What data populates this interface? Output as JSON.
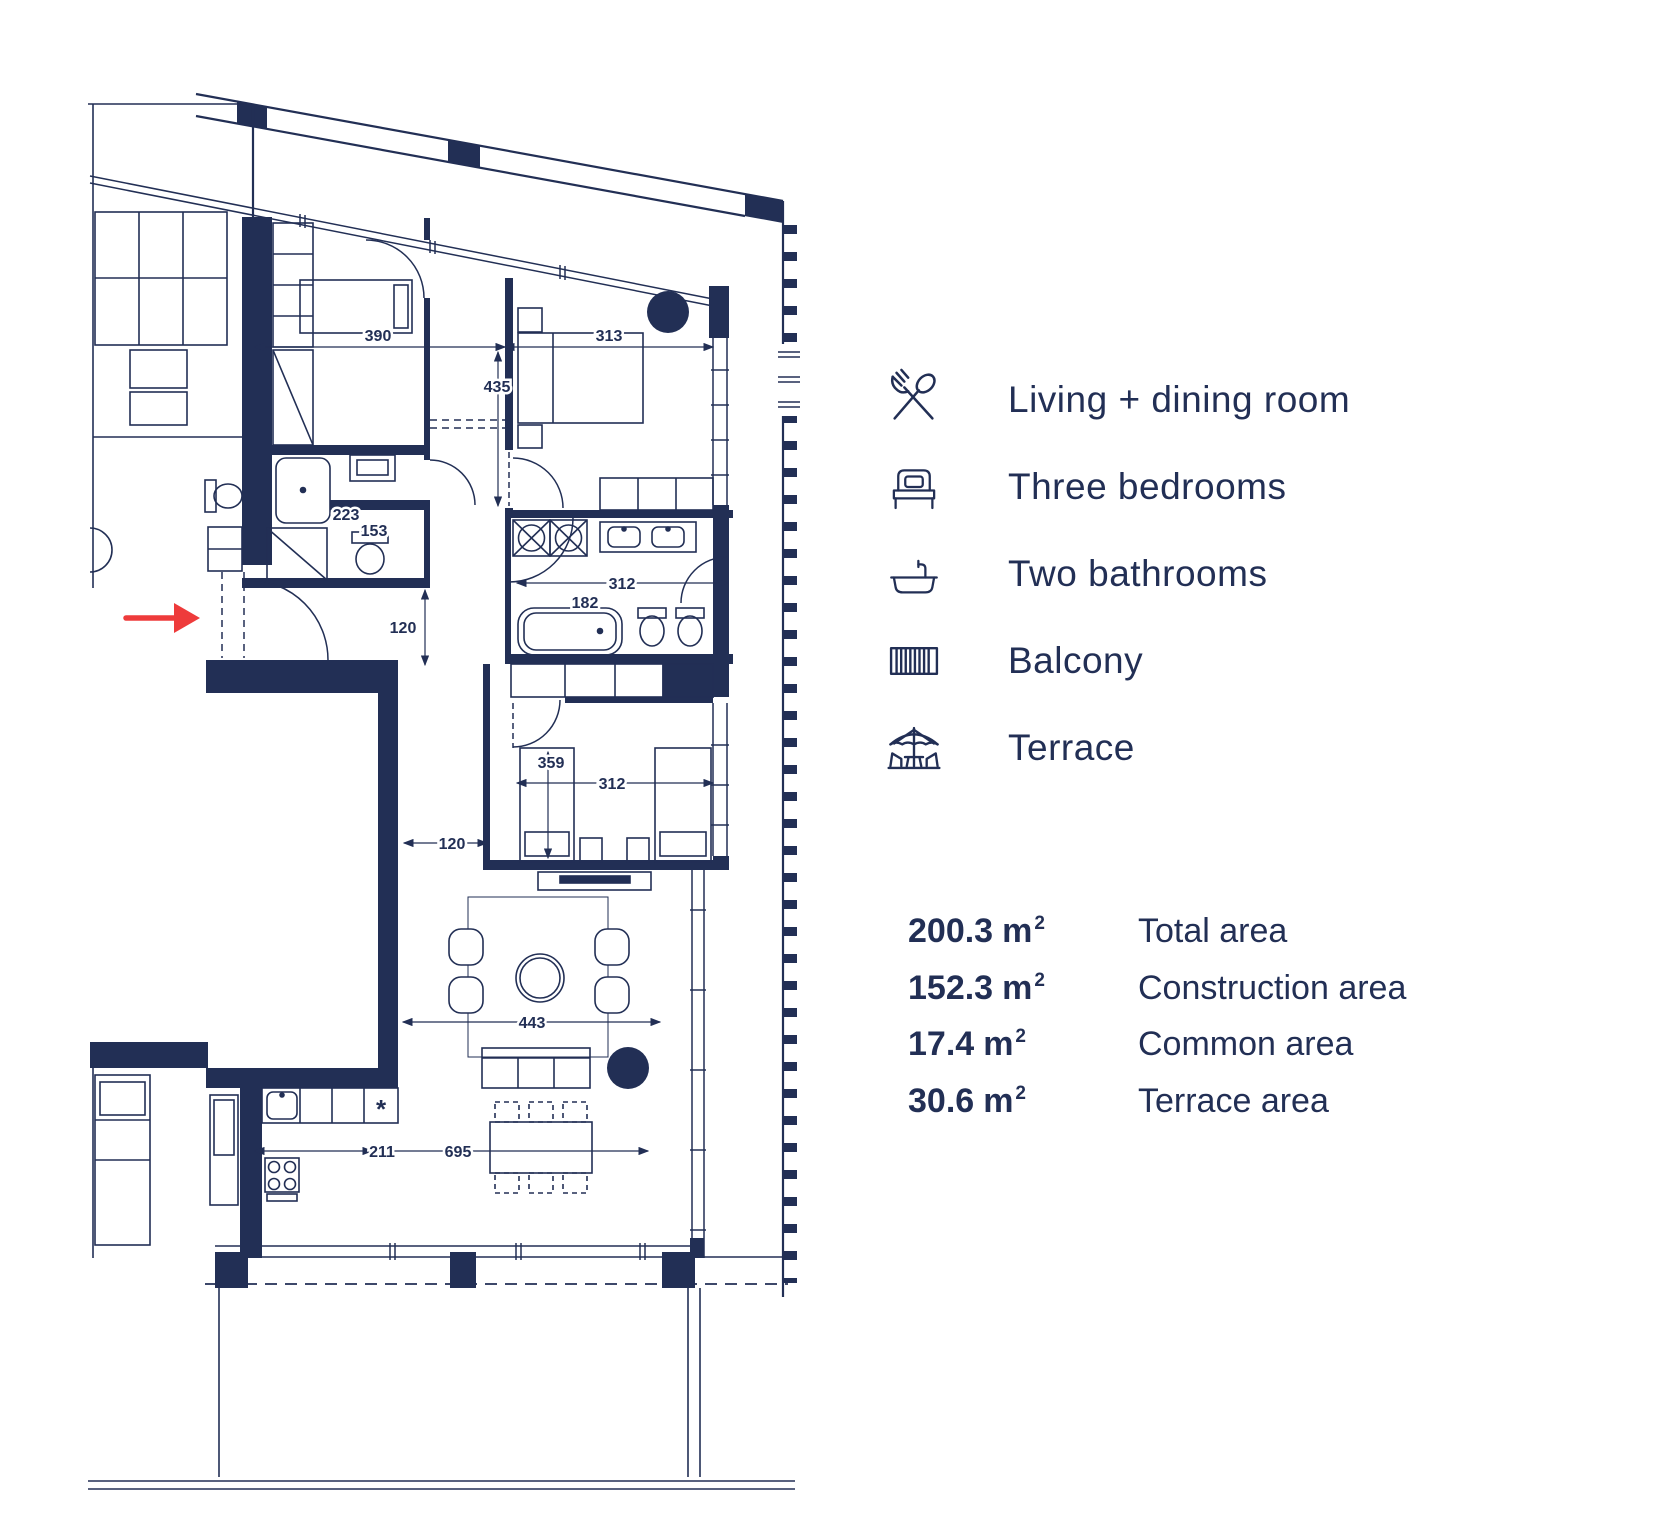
{
  "plan": {
    "colors": {
      "line": "#222F55",
      "accent": "#EE3B3B",
      "background": "#FFFFFF"
    },
    "kitchen_symbol": "*",
    "dimensions": [
      {
        "value": "390"
      },
      {
        "value": "313"
      },
      {
        "value": "435"
      },
      {
        "value": "223"
      },
      {
        "value": "153"
      },
      {
        "value": "120"
      },
      {
        "value": "312"
      },
      {
        "value": "182"
      },
      {
        "value": "359"
      },
      {
        "value": "312"
      },
      {
        "value": "120"
      },
      {
        "value": "443"
      },
      {
        "value": "211"
      },
      {
        "value": "695"
      }
    ]
  },
  "legend": {
    "items": [
      {
        "icon": "cutlery-icon",
        "label": "Living + dining room"
      },
      {
        "icon": "bed-icon",
        "label": "Three bedrooms"
      },
      {
        "icon": "bathtub-icon",
        "label": "Two bathrooms"
      },
      {
        "icon": "balcony-icon",
        "label": "Balcony"
      },
      {
        "icon": "terrace-icon",
        "label": "Terrace"
      }
    ]
  },
  "areas": {
    "rows": [
      {
        "value": "200.3",
        "unit": "m",
        "sup": "2",
        "label": "Total area"
      },
      {
        "value": "152.3",
        "unit": "m",
        "sup": "2",
        "label": "Construction area"
      },
      {
        "value": "17.4",
        "unit": "m",
        "sup": "2",
        "label": "Common area"
      },
      {
        "value": "30.6",
        "unit": "m",
        "sup": "2",
        "label": "Terrace area"
      }
    ]
  }
}
